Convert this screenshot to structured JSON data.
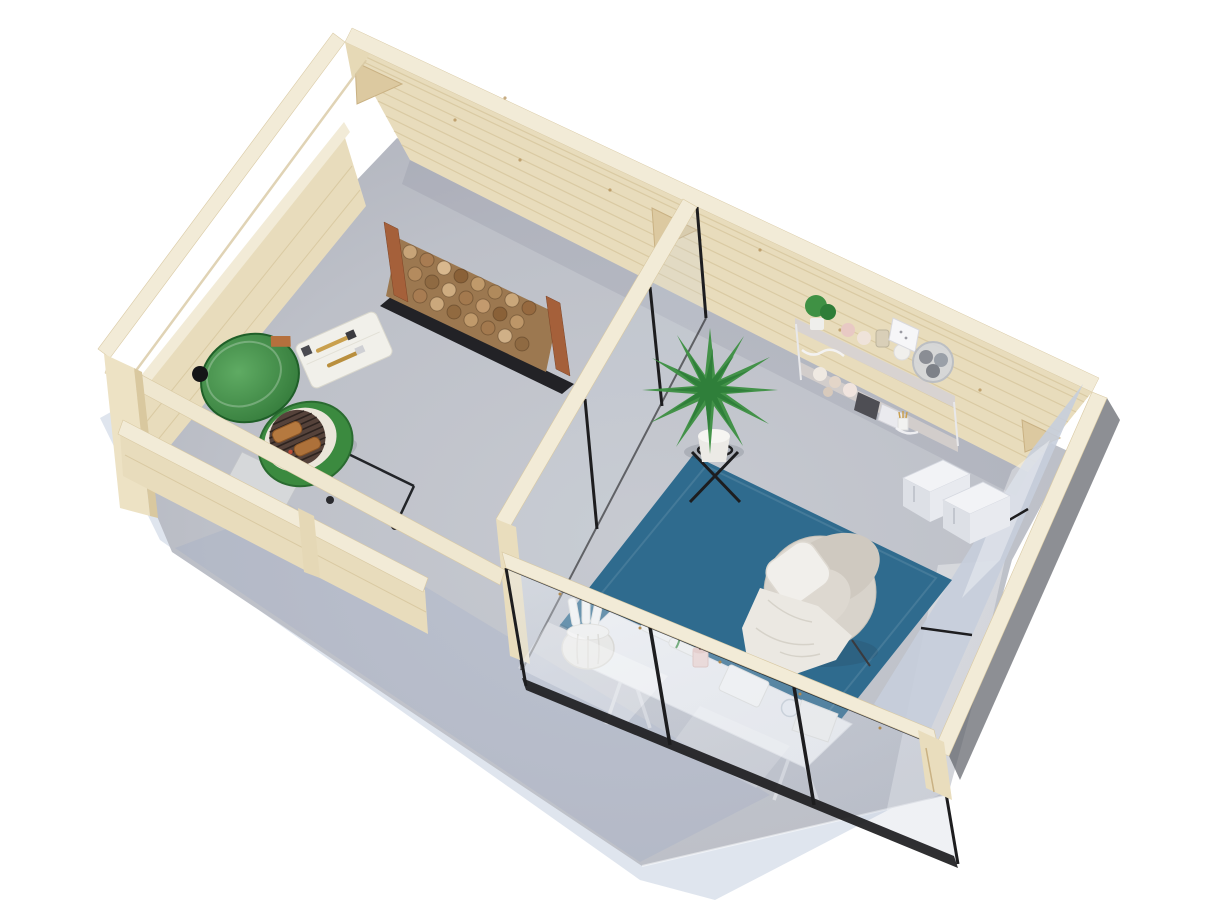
{
  "meta": {
    "description": "Aerial 3D product render of a timber garden cabin: open pergola BBQ terrace on the left, glazed garden room on the right, on a grey concrete slab over a white background",
    "view": "top-down three-quarter aerial",
    "background_color": "#ffffff"
  },
  "colors": {
    "background": "#ffffff",
    "wood_light": "#f2ebd7",
    "wood_wall": "#e8dcbc",
    "wood_shade": "#d9c9a3",
    "wood_post_brown": "#a5603a",
    "floor_concrete": "#bdc0c8",
    "ground_shadow": "#c5cfe0",
    "glass_tint": "#c6cedb",
    "frame_black": "#1d1d1f",
    "rug_teal": "#2f6b8e",
    "grill_green": "#3b8a3f",
    "grill_green_dark": "#2a6b30",
    "ceramic_white": "#ebe6da",
    "plant_green": "#3f9144",
    "plant_green_dark": "#2e7d38",
    "firewood_brown": "#9c7850",
    "chair_beige": "#d8d3cb",
    "textile_white": "#f1efeb",
    "desk_white": "#f1f2f4",
    "box_white": "#f2f3f6",
    "candle_pink": "#f3dbd6"
  },
  "scene": {
    "building": {
      "label": "timber garden cabin seen from above",
      "sections": [
        {
          "label": "open pergola BBQ terrace with half-height walls"
        },
        {
          "label": "enclosed garden room with black-framed glass walls"
        }
      ]
    },
    "terrace_items": [
      {
        "label": "green kamado grill with open dome lid"
      },
      {
        "label": "grill side table with BBQ brushes"
      },
      {
        "label": "foil drip tray"
      },
      {
        "label": "firewood storage rack with stacked logs"
      }
    ],
    "room_items": [
      {
        "label": "teal area rug"
      },
      {
        "label": "beige armchair with white pillow and draped blanket"
      },
      {
        "label": "potted palm on black stand"
      },
      {
        "label": "white wall shelf with pots, yarn and wire basket"
      },
      {
        "label": "wall outlet panel"
      },
      {
        "label": "two white storage boxes"
      },
      {
        "label": "white trestle desk with candle, notebook and glass"
      },
      {
        "label": "woven basket with rolled papers"
      }
    ]
  }
}
